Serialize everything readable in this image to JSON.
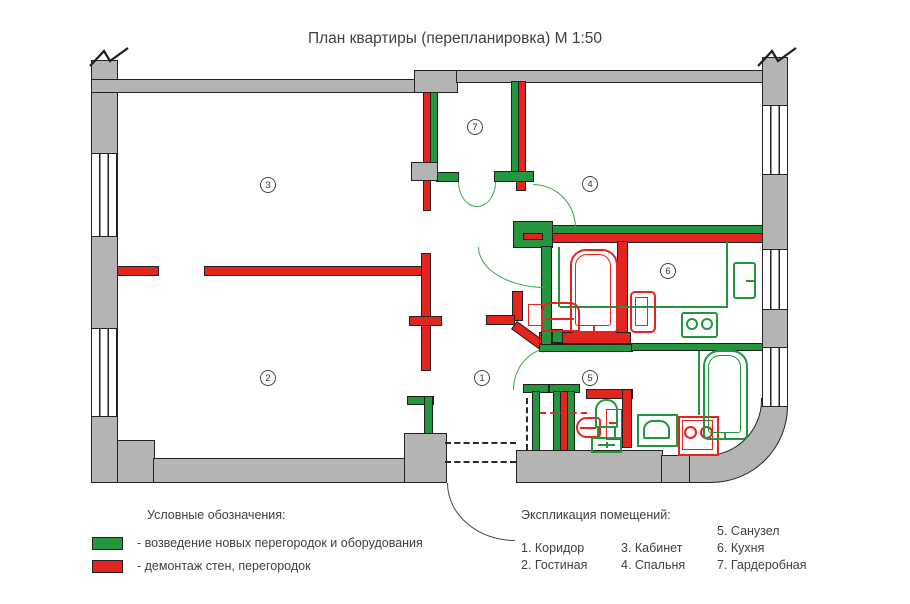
{
  "title": "План квартиры (перепланировка) М 1:50",
  "colors": {
    "new_work_green": "#23963f",
    "demolition_red": "#e22521",
    "wall_gray": "#b4b4b4",
    "outline": "#1f1f1f"
  },
  "legend": {
    "heading": "Условные обозначения:",
    "items": [
      {
        "swatch": "#23963f",
        "label": "- возведение новых перегородок и оборудования"
      },
      {
        "swatch": "#e22521",
        "label": "- демонтаж стен, перегородок"
      }
    ]
  },
  "explication": {
    "heading": "Экспликация помещений:",
    "columns": [
      [
        "1. Коридор",
        "2. Гостиная"
      ],
      [
        "3. Кабинет",
        "4. Спальня"
      ],
      [
        "5. Санузел",
        "6. Кухня",
        "7. Гардеробная"
      ]
    ]
  },
  "rooms": [
    {
      "number": "1",
      "name": "Коридор"
    },
    {
      "number": "2",
      "name": "Гостиная"
    },
    {
      "number": "3",
      "name": "Кабинет"
    },
    {
      "number": "4",
      "name": "Спальня"
    },
    {
      "number": "5",
      "name": "Санузел"
    },
    {
      "number": "6",
      "name": "Кухня"
    },
    {
      "number": "7",
      "name": "Гардеробная"
    }
  ]
}
